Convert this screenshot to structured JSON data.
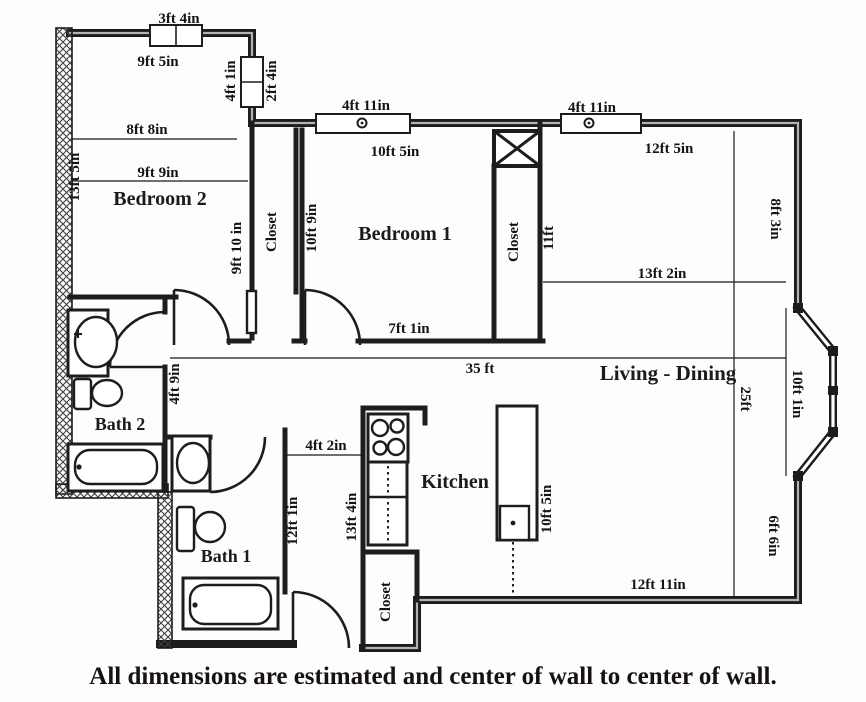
{
  "colors": {
    "wall": "#1c1c1c",
    "wall_core": "#b3b3b3",
    "hatch": "#444444",
    "text": "#141414",
    "caption": "#17101a",
    "background": "#fdfdfb"
  },
  "labels": {
    "win_top": "3ft 4in",
    "top_width": "9ft 5in",
    "side_win_in": "4ft 1in",
    "side_win_out": "2ft 4in",
    "b2_w1": "8ft 8in",
    "b2_w2": "9ft 9in",
    "b2_h": "13ft 5in",
    "bedroom2": "Bedroom 2",
    "closet1_h": "9ft 10 in",
    "closet1": "Closet",
    "closet1_r": "10ft 9in",
    "b1_win": "4ft 11in",
    "b1_top": "10ft 5in",
    "bedroom1": "Bedroom 1",
    "closet2": "Closet",
    "closet2_h": "11ft",
    "ld_win": "4ft 11in",
    "ld_top": "12ft 5in",
    "ld_right_u": "8ft 3in",
    "ld_w": "13ft 2in",
    "b1_bottom": "7ft 1in",
    "hall_len": "35 ft",
    "living": "Living - Dining",
    "ld_h": "25ft",
    "bay_h": "10ft 1in",
    "corridor_w": "4ft 9in",
    "bath2": "Bath 2",
    "kit_entry": "4ft 2in",
    "kitchen": "Kitchen",
    "hall2_h": "12ft 1in",
    "kit_h": "13ft 4in",
    "island_h": "10ft 5in",
    "ld_right_l": "6ft 6in",
    "bath1": "Bath 1",
    "closet3": "Closet",
    "ld_bottom": "12ft 11in",
    "caption": "All dimensions are estimated and center of wall to center of wall."
  }
}
